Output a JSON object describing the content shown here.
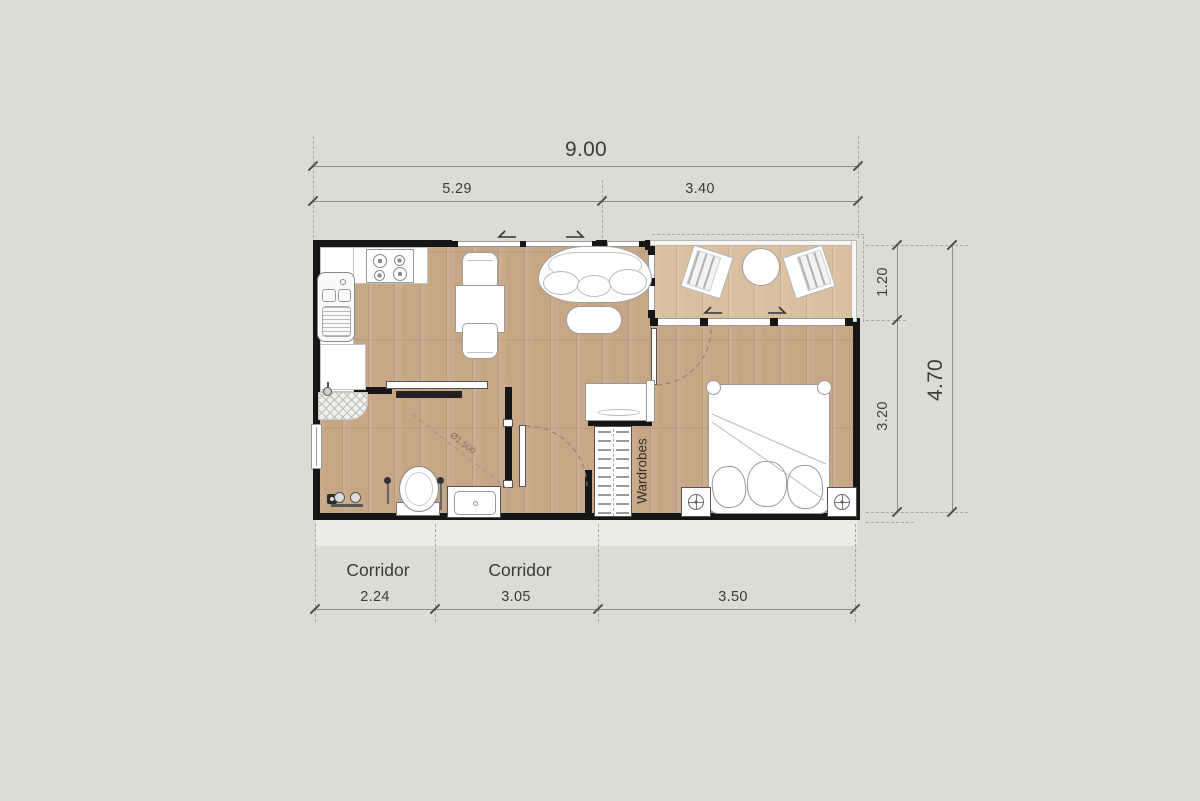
{
  "dimensions": {
    "top": {
      "overall": "9.00",
      "seg1": "5.29",
      "seg2": "3.40"
    },
    "right": {
      "overall": "4.70",
      "seg1": "1.20",
      "seg2": "3.20"
    },
    "bottom": {
      "seg1": "2.24",
      "seg2": "3.05",
      "seg3": "3.50"
    }
  },
  "labels": {
    "corridor_left": "Corridor",
    "corridor_mid": "Corridor",
    "wardrobes": "Wardrobes",
    "turning_circle": "Ø1.500"
  },
  "colors": {
    "background": "#dcdcd5",
    "wall": "#161616",
    "floor_wood": "#c7a685",
    "terrace_wood": "#dabf9e",
    "furniture_outline": "#a0a0a0",
    "dimension_text": "#3c3c3c",
    "dimension_line": "#90908a"
  }
}
